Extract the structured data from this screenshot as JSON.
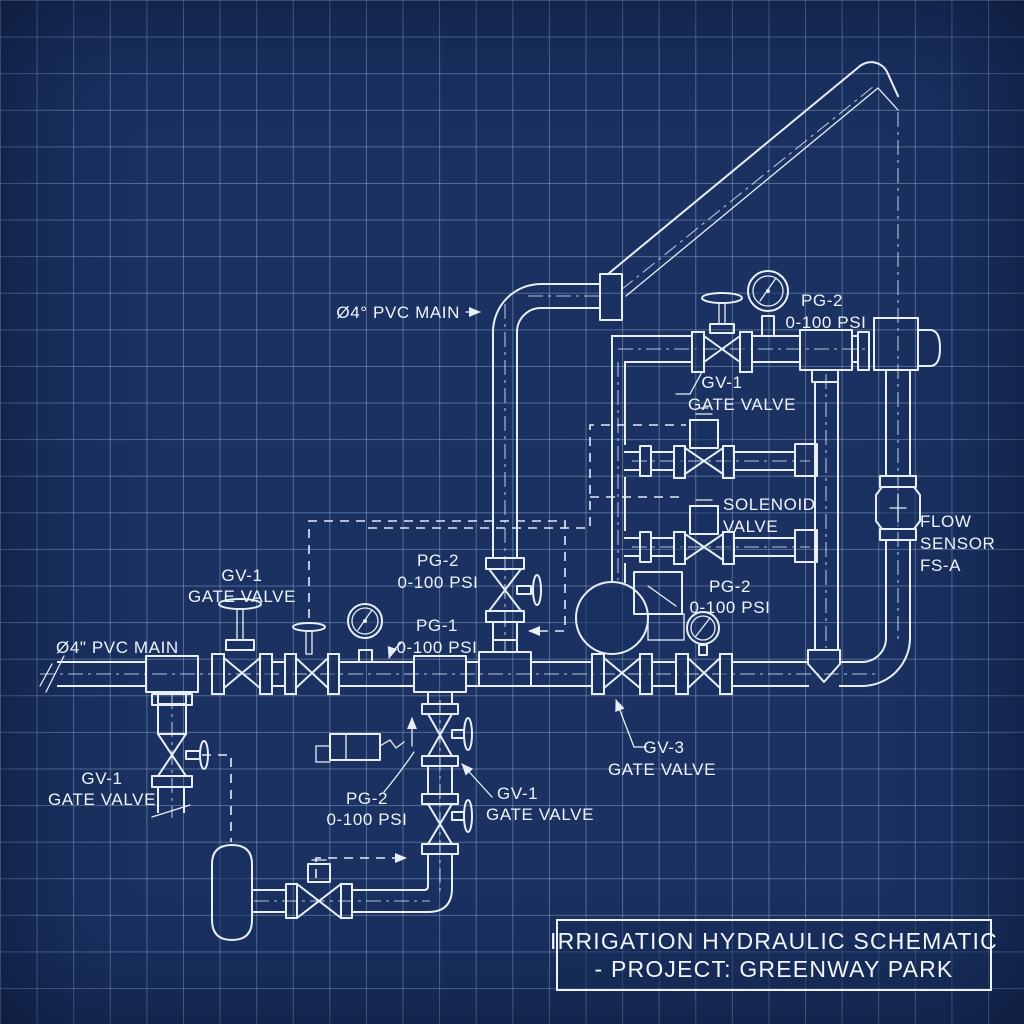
{
  "drawing": {
    "background_color": "#1a3161",
    "grid_color": "#acc5e6",
    "line_color": "#e9eff9"
  },
  "labels": {
    "main_top": "Ø4° PVC MAIN",
    "main_left": "Ø4\" PVC MAIN",
    "pg2_top": [
      "PG-2",
      "0-100 PSI"
    ],
    "gv1_top": [
      "GV-1",
      "GATE VALVE"
    ],
    "solenoid": [
      "SOLENOID",
      "VALVE"
    ],
    "flow_sensor": [
      "FLOW",
      "SENSOR",
      "FS-A"
    ],
    "pg2_mid": [
      "PG-2",
      "0-100 PSI"
    ],
    "pg1": [
      "PG-1",
      "0-100 PSI"
    ],
    "gv1_left": [
      "GV-1",
      "GATE VALVE"
    ],
    "pg2_right": [
      "PG-2",
      "0-100 PSI"
    ],
    "gv3": [
      "GV-3",
      "GATE VALVE"
    ],
    "gv1_bottom_left": [
      "GV-1",
      "GATE VALVE"
    ],
    "pg2_bottom": [
      "PG-2",
      "0-100 PSI"
    ],
    "gv1_bottom": [
      "GV-1",
      "GATE VALVE"
    ]
  },
  "title_block": {
    "line1": "IRRIGATION HYDRAULIC SCHEMATIC",
    "line2": "- PROJECT: GREENWAY PARK"
  }
}
